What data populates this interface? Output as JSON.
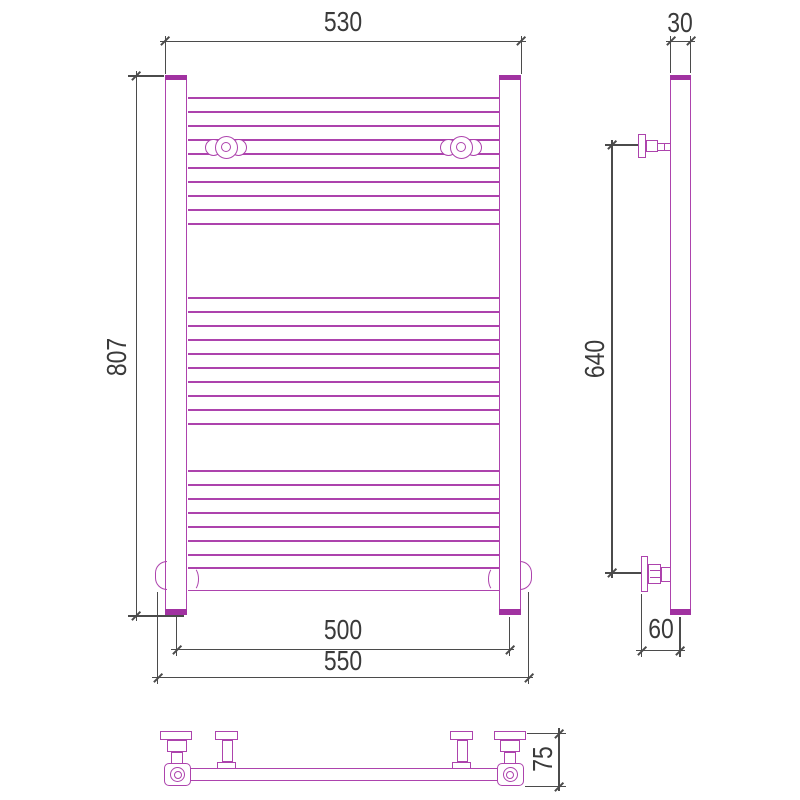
{
  "drawing": {
    "type": "technical-drawing",
    "subject": "ladder towel radiator, three orthographic views",
    "units": "mm"
  },
  "colors": {
    "outline": "#ad43ad",
    "outline_dark": "#a132a1",
    "dim_line": "#4b4b4b",
    "dim_text": "#3a3a3a",
    "background": "#ffffff"
  },
  "dimensions": {
    "top_width": "530",
    "overall_height": "807",
    "post_spacing": "500",
    "bottom_width": "550",
    "tube_diameter": "30",
    "bracket_spacing": "640",
    "wall_clearance": "60",
    "bracket_depth": "75"
  },
  "front_view": {
    "x1": 188,
    "x2": 499,
    "rung_groups": [
      {
        "y_start": 97,
        "step": 14,
        "count": 10
      },
      {
        "y_start": 297,
        "step": 14,
        "count": 10
      },
      {
        "y_start": 470,
        "step": 14,
        "count": 7
      }
    ]
  }
}
